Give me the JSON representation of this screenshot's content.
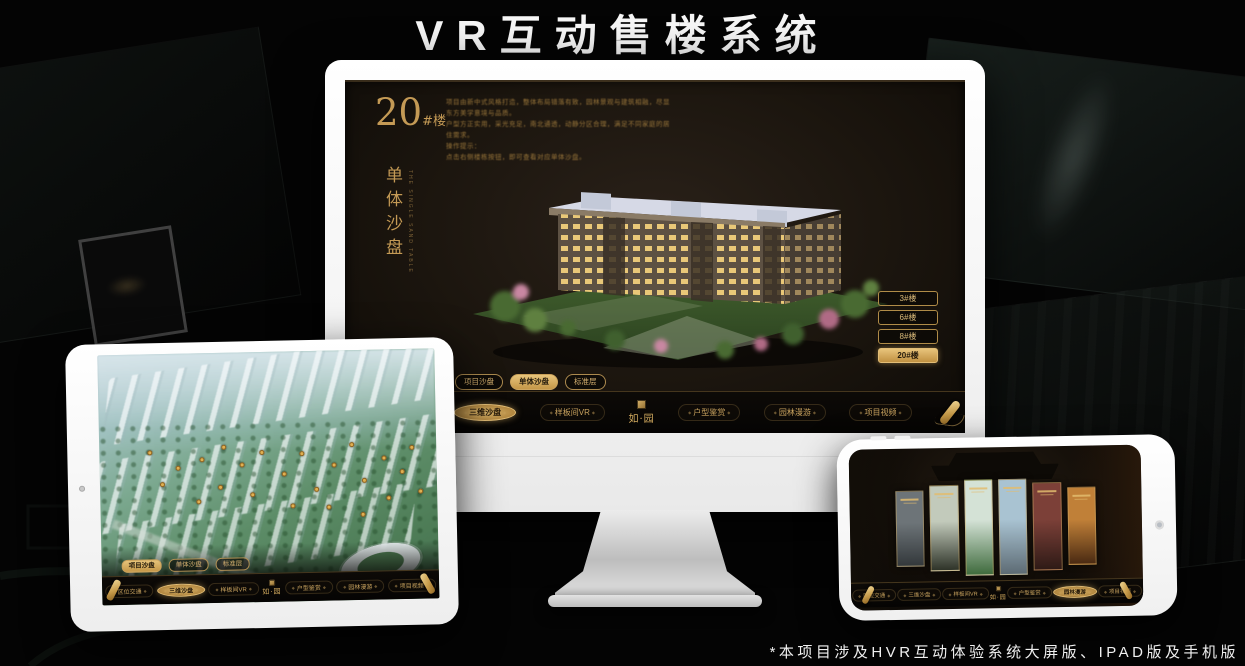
{
  "page": {
    "title": "VR互动售楼系统",
    "footnote": "*本项目涉及HVR互动体验系统大屏版、IPAD版及手机版"
  },
  "colors": {
    "gold": "#c9a15c",
    "gold_selected": "#e7c47b",
    "screen_background": "#1b150e",
    "marker_gold": "#e0b052"
  },
  "desktop": {
    "block_number": "20",
    "block_suffix": "#楼",
    "block_subtitle": "单体沙盘",
    "block_subtitle_en": "THE SINGLE SAND TABLE",
    "description_lines": [
      "项目由新中式风格打造，整体布局错落有致，园林景观与建筑相融，尽显东方美学意境与品质。",
      "户型方正实用，采光充足，南北通透，动静分区合理，满足不同家庭的居住需求。",
      "操作提示：",
      "点击右侧楼栋按钮，即可查看对应单体沙盘。"
    ],
    "floor_buttons": [
      {
        "label": "3#楼",
        "selected": false
      },
      {
        "label": "6#楼",
        "selected": false
      },
      {
        "label": "8#楼",
        "selected": false
      },
      {
        "label": "20#楼",
        "selected": true
      }
    ],
    "view_tabs": [
      {
        "label": "项目沙盘",
        "selected": false
      },
      {
        "label": "单体沙盘",
        "selected": true
      },
      {
        "label": "标准层",
        "selected": false
      }
    ],
    "menu_active": "三维沙盘"
  },
  "menu": {
    "items_left": [
      "区位交通",
      "三维沙盘",
      "样板间VR"
    ],
    "logo": "如·园",
    "items_right": [
      "户型鉴赏",
      "园林漫游",
      "项目视频"
    ]
  },
  "tablet": {
    "view_tabs": [
      {
        "label": "项目沙盘",
        "selected": true
      },
      {
        "label": "单体沙盘",
        "selected": false
      },
      {
        "label": "标准层",
        "selected": false
      }
    ],
    "menu_active": "三维沙盘"
  },
  "phone": {
    "menu_active": "园林漫游",
    "panels": [
      {
        "top": "#6d7478",
        "bottom": "#33383b"
      },
      {
        "top": "#c2cabb",
        "bottom": "#2e3328"
      },
      {
        "top": "#d4e2d6",
        "bottom": "#3f6b3d"
      },
      {
        "top": "#a9c3d2",
        "bottom": "#5d6b74"
      },
      {
        "top": "#7c4038",
        "bottom": "#2e1a16"
      },
      {
        "top": "#c08038",
        "bottom": "#4a2a12"
      }
    ]
  }
}
